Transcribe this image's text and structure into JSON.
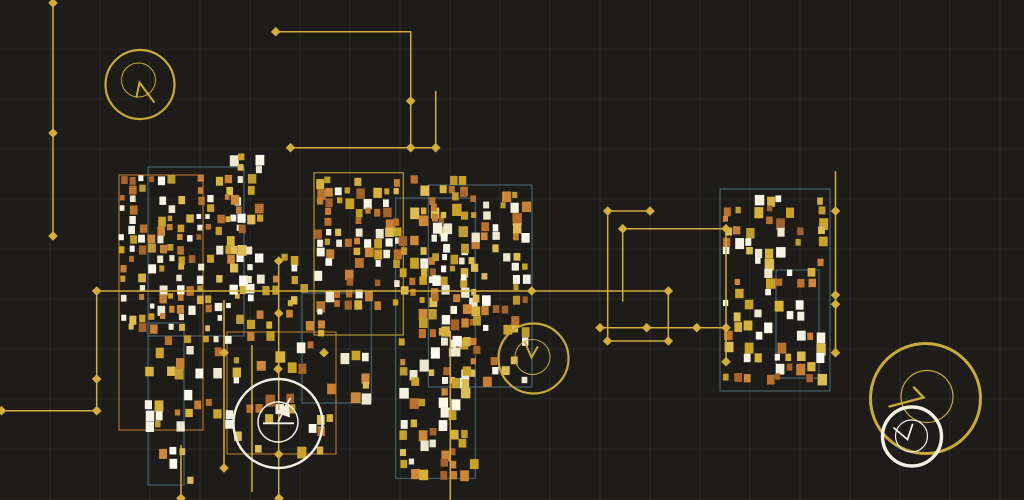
{
  "artwork": {
    "kind": "generative-circuit-art",
    "canvas": {
      "width": 1024,
      "height": 500,
      "background": "#1d1c19"
    },
    "grid": {
      "spacing": 50,
      "color": "#ffffff",
      "opacity": 0.055,
      "offset_y": -1
    },
    "colors": {
      "trace": "#d4ad3a",
      "teal_outline": "#5d8a99",
      "orange_outline": "#b5762c",
      "gold_outline": "#b99b35",
      "gold_dial": "#c9a83c",
      "white_dial": "#f4f1e4",
      "square_golds": [
        "#d6b23c",
        "#c9a227",
        "#bf9a2f",
        "#ddbb55"
      ],
      "square_oranges": [
        "#b9712c",
        "#c67f33",
        "#a5622a",
        "#cc8838"
      ],
      "square_whites": [
        "#f6f2e2",
        "#eee7d0",
        "#fbf8ec"
      ]
    },
    "color_weights": {
      "gold": 0.37,
      "orange": 0.3,
      "white": 0.33
    },
    "outline_rects": [
      {
        "x": 148,
        "y": 167,
        "w": 96,
        "h": 169,
        "c": "teal"
      },
      {
        "x": 148,
        "y": 323,
        "w": 36,
        "h": 162,
        "c": "teal"
      },
      {
        "x": 428.3,
        "y": 185,
        "w": 103.7,
        "h": 202,
        "c": "teal"
      },
      {
        "x": 395.7,
        "y": 198,
        "w": 79.6,
        "h": 280.3,
        "c": "teal"
      },
      {
        "x": 302,
        "y": 293,
        "w": 69.3,
        "h": 110,
        "c": "teal"
      },
      {
        "x": 776,
        "y": 270,
        "w": 43,
        "h": 108,
        "c": "teal"
      },
      {
        "x": 720,
        "y": 189,
        "w": 110,
        "h": 202,
        "c": "teal"
      },
      {
        "x": 119,
        "y": 175,
        "w": 84,
        "h": 255,
        "c": "orange"
      },
      {
        "x": 227,
        "y": 332,
        "w": 109,
        "h": 122,
        "c": "orange"
      },
      {
        "x": 314,
        "y": 172.7,
        "w": 89.3,
        "h": 162.3,
        "c": "gold"
      }
    ],
    "traces": [
      {
        "points": [
          [
            53,
            2
          ],
          [
            53,
            236
          ]
        ],
        "nodes": [
          [
            53,
            3
          ],
          [
            53,
            133
          ],
          [
            53,
            236
          ]
        ]
      },
      {
        "points": [
          [
            275.7,
            31.7
          ],
          [
            410.7,
            31.7
          ],
          [
            410.7,
            147.7
          ]
        ],
        "nodes": [
          [
            275.7,
            31.7
          ],
          [
            410.7,
            101
          ],
          [
            410.7,
            147.7
          ]
        ]
      },
      {
        "points": [
          [
            290.5,
            147.7
          ],
          [
            435.7,
            147.7
          ]
        ],
        "nodes": [
          [
            290.5,
            147.7
          ],
          [
            435.7,
            147.7
          ]
        ]
      },
      {
        "points": [
          [
            435.7,
            91
          ],
          [
            435.7,
            147.7
          ]
        ],
        "nodes": []
      },
      {
        "points": [
          [
            0,
            410.7
          ],
          [
            96.7,
            410.7
          ],
          [
            96.7,
            291
          ],
          [
            668.3,
            291
          ],
          [
            668.3,
            341
          ],
          [
            607.5,
            341
          ]
        ],
        "nodes": [
          [
            1.5,
            410.7
          ],
          [
            96.7,
            410.7
          ],
          [
            96.7,
            379
          ],
          [
            96.7,
            291
          ],
          [
            531.7,
            291
          ],
          [
            668.3,
            291
          ],
          [
            668.3,
            341
          ],
          [
            607.5,
            341
          ]
        ]
      },
      {
        "points": [
          [
            650,
            211
          ],
          [
            607.7,
            211
          ],
          [
            607.7,
            341
          ]
        ],
        "nodes": [
          [
            650,
            211
          ],
          [
            607.7,
            211
          ]
        ]
      },
      {
        "points": [
          [
            622.7,
            228.7
          ],
          [
            726,
            228.7
          ],
          [
            726,
            361.7
          ]
        ],
        "nodes": [
          [
            622.7,
            228.7
          ],
          [
            726,
            228.7
          ],
          [
            726,
            327.7
          ],
          [
            726,
            361.7
          ]
        ]
      },
      {
        "points": [
          [
            600,
            327.7
          ],
          [
            726,
            327.7
          ]
        ],
        "nodes": [
          [
            600,
            327.7
          ],
          [
            646.7,
            327.7
          ],
          [
            696.7,
            327.7
          ]
        ]
      },
      {
        "points": [
          [
            622.7,
            228.7
          ],
          [
            622.7,
            301.7
          ]
        ],
        "nodes": []
      },
      {
        "points": [
          [
            835.5,
            171
          ],
          [
            835.5,
            352.7
          ]
        ],
        "nodes": [
          [
            835.5,
            211
          ],
          [
            835.5,
            295
          ],
          [
            835.5,
            304.3
          ],
          [
            835.5,
            352.7
          ]
        ]
      },
      {
        "points": [
          [
            278.7,
            261
          ],
          [
            278.7,
            498.3
          ]
        ],
        "nodes": [
          [
            278.7,
            261
          ],
          [
            278.7,
            313.3
          ],
          [
            278,
            369
          ],
          [
            278.7,
            454.3
          ],
          [
            279,
            498.3
          ]
        ]
      },
      {
        "points": [
          [
            224,
            300
          ],
          [
            224,
            468
          ]
        ],
        "nodes": [
          [
            224,
            352.7
          ],
          [
            224,
            468
          ]
        ]
      },
      {
        "points": [
          [
            252,
            345
          ],
          [
            252,
            492
          ]
        ],
        "nodes": []
      },
      {
        "points": [
          [
            181,
            445
          ],
          [
            181,
            498.3
          ]
        ],
        "nodes": [
          [
            181,
            498.3
          ]
        ]
      },
      {
        "points": [
          [
            450.3,
            331
          ],
          [
            450.3,
            500
          ]
        ],
        "nodes": []
      }
    ],
    "stray_nodes": [
      [
        324,
        352.7
      ]
    ],
    "trace_style": {
      "width": 1.5,
      "node_size": 4.8
    },
    "dials": [
      {
        "name": "dial-top-left",
        "color": "gold",
        "outer": {
          "cx": 140,
          "cy": 84.5,
          "r": 34.5,
          "sw": 2.2
        },
        "inner": {
          "cx": 138.5,
          "cy": 80,
          "r": 17,
          "sw": 1
        },
        "hand": {
          "d": "M136.5,97 L139.5,82.5 L154,102",
          "sw": 2
        }
      },
      {
        "name": "dial-center",
        "color": "gold",
        "outer": {
          "cx": 533.5,
          "cy": 358.5,
          "r": 35,
          "sw": 2.2
        },
        "inner": {
          "cx": 532.5,
          "cy": 357,
          "r": 17.5,
          "sw": 1
        },
        "hand": {
          "d": "M525,342.5 L531.5,357.5 L537.5,347",
          "sw": 2
        }
      },
      {
        "name": "dial-white-left",
        "color": "white",
        "outer": {
          "cx": 278,
          "cy": 423.5,
          "r": 44.5,
          "sw": 2.4
        },
        "inner": {
          "cx": 278,
          "cy": 422,
          "r": 20,
          "sw": 1.5
        },
        "hand": {
          "d": "M278.5,421 L290,398.5",
          "sw": 1.8
        },
        "extras": [
          {
            "d": "M263,423.3 L294,423.3",
            "sw": 1.8,
            "fill": false
          },
          {
            "d": "M288.5,402.5 L290,417.5 L275.5,412.5 Z",
            "sw": 0,
            "fill": true
          }
        ]
      },
      {
        "name": "dial-big-right",
        "color": "gold",
        "outer": {
          "cx": 925.5,
          "cy": 398.5,
          "r": 55,
          "sw": 3
        },
        "inner": {
          "cx": 927,
          "cy": 396.5,
          "r": 26,
          "sw": 1.2
        },
        "hand": {
          "d": "M914,387.5 L923.5,397.5 L889.5,406.5",
          "sw": 2.4
        }
      },
      {
        "name": "dial-white-right",
        "color": "white",
        "outer": {
          "cx": 912,
          "cy": 436.5,
          "r": 29.5,
          "sw": 3.4
        },
        "inner": {
          "cx": 911.5,
          "cy": 436,
          "r": 16,
          "sw": 1.2
        },
        "hand": {
          "d": "M894,428 L907.5,439.5 L912.5,424.5",
          "sw": 1.8
        }
      }
    ],
    "clusters": [
      {
        "x": 120,
        "y": 176,
        "w": 125,
        "h": 158,
        "cols": 13,
        "rows": 16,
        "density": 0.52,
        "smin": 4.5,
        "smax": 8,
        "seed": 11
      },
      {
        "x": 146,
        "y": 336,
        "w": 98,
        "h": 106,
        "cols": 10,
        "rows": 10,
        "density": 0.34,
        "smin": 5,
        "smax": 9,
        "seed": 22
      },
      {
        "x": 150,
        "y": 448,
        "w": 48,
        "h": 48,
        "cols": 5,
        "rows": 5,
        "density": 0.3,
        "smin": 5,
        "smax": 8,
        "seed": 33
      },
      {
        "x": 230,
        "y": 145,
        "w": 34,
        "h": 160,
        "cols": 4,
        "rows": 16,
        "density": 0.42,
        "smin": 5,
        "smax": 9,
        "seed": 44
      },
      {
        "x": 262,
        "y": 255,
        "w": 50,
        "h": 50,
        "cols": 5,
        "rows": 5,
        "density": 0.38,
        "smin": 5,
        "smax": 8,
        "seed": 55
      },
      {
        "x": 316,
        "y": 178,
        "w": 88,
        "h": 132,
        "cols": 9,
        "rows": 13,
        "density": 0.52,
        "smin": 5,
        "smax": 9,
        "seed": 66
      },
      {
        "x": 246,
        "y": 300,
        "w": 92,
        "h": 52,
        "cols": 9,
        "rows": 5,
        "density": 0.4,
        "smin": 5,
        "smax": 9,
        "seed": 77
      },
      {
        "x": 246,
        "y": 352,
        "w": 92,
        "h": 104,
        "cols": 9,
        "rows": 10,
        "density": 0.22,
        "smin": 6,
        "smax": 10,
        "seed": 88
      },
      {
        "x": 342,
        "y": 352,
        "w": 30,
        "h": 52,
        "cols": 3,
        "rows": 5,
        "density": 0.45,
        "smin": 6,
        "smax": 10,
        "seed": 99
      },
      {
        "x": 400,
        "y": 176,
        "w": 80,
        "h": 304,
        "cols": 8,
        "rows": 30,
        "density": 0.42,
        "smin": 5,
        "smax": 9.5,
        "seed": 111
      },
      {
        "x": 432,
        "y": 192,
        "w": 100,
        "h": 196,
        "cols": 10,
        "rows": 19,
        "density": 0.42,
        "smin": 5,
        "smax": 9.5,
        "seed": 123
      },
      {
        "x": 724,
        "y": 196,
        "w": 104,
        "h": 188,
        "cols": 10,
        "rows": 18,
        "density": 0.42,
        "smin": 5,
        "smax": 9.5,
        "seed": 137
      }
    ]
  }
}
